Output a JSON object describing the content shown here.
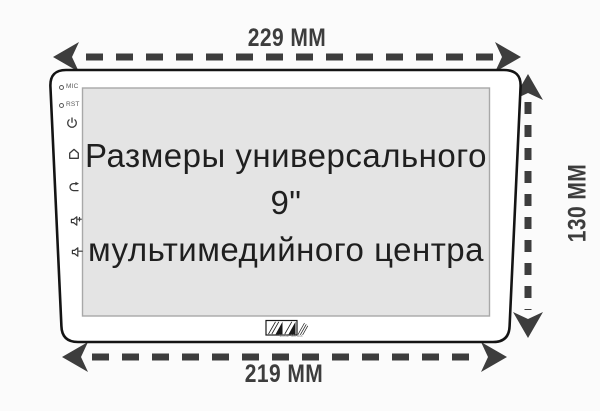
{
  "diagram": {
    "screen_title": {
      "line1": "Размеры универсального 9\"",
      "line2": "мультимедийного центра"
    },
    "dimensions": {
      "top": "229 ММ",
      "bottom": "219 ММ",
      "right": "130 ММ"
    },
    "side_panel": {
      "mic_label": "MIC",
      "rst_label": "RST",
      "icons": [
        "mic-hole-icon",
        "reset-hole-icon",
        "power-icon",
        "home-icon",
        "back-icon",
        "volume-up-icon",
        "volume-down-icon"
      ]
    },
    "logo": {
      "caption": "Wide Media",
      "mark": "wm-hatched-monogram"
    },
    "colors": {
      "background": "#fbfbfb",
      "dimension_arrows": "#3d3d3d",
      "device_outline": "#141414",
      "screen_fill": "#e4e4e4",
      "screen_border": "#a8a8a8",
      "icon": "#383838"
    }
  }
}
